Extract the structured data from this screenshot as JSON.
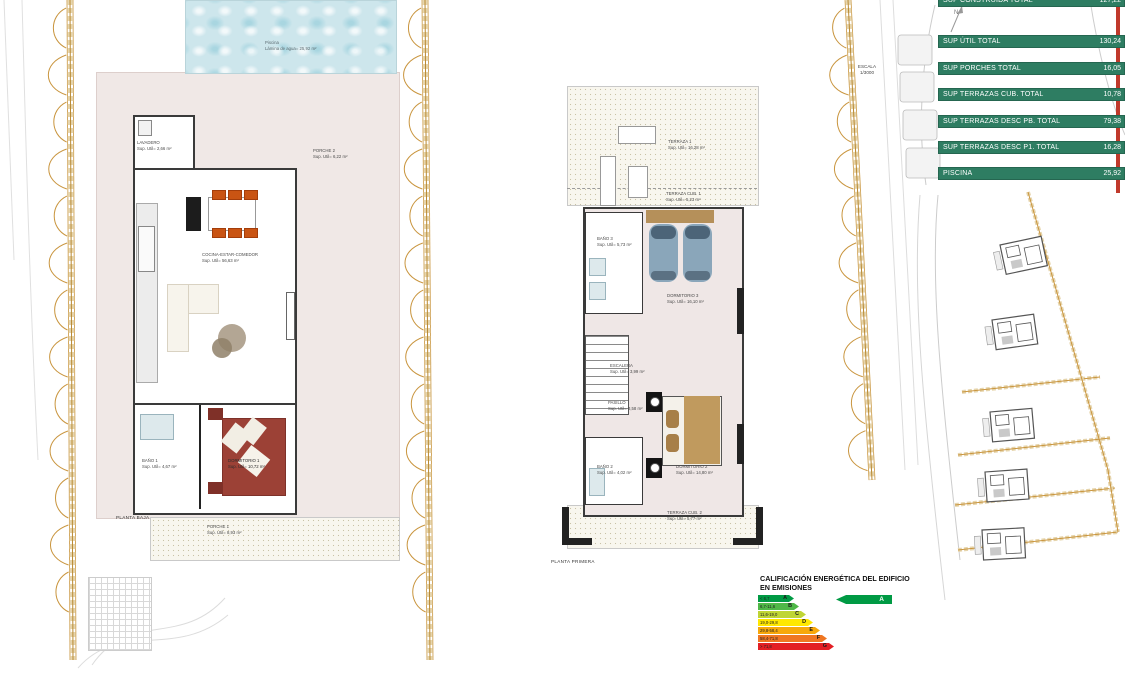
{
  "areas_table": {
    "bar_color": "#2e7d62",
    "rows": [
      {
        "label": "SUP CONSTRUIDA TOTAL",
        "value": "127,22"
      },
      {
        "label": "SUP ÚTIL TOTAL",
        "value": "130,24"
      },
      {
        "label": "SUP PORCHES TOTAL",
        "value": "16,05"
      },
      {
        "label": "SUP TERRAZAS CUB. TOTAL",
        "value": "10,78"
      },
      {
        "label": "SUP TERRAZAS DESC PB. TOTAL",
        "value": "79,38"
      },
      {
        "label": "SUP TERRAZAS DESC P1. TOTAL",
        "value": "16,28"
      },
      {
        "label": "PISCINA",
        "value": "25,92"
      }
    ]
  },
  "ground_floor": {
    "name_label": "PLANTA BAJA",
    "pool": {
      "line1": "Piscina",
      "line2": "Lámina de agua= 25,92 m²"
    },
    "rooms": [
      {
        "name": "LAVADERO",
        "area": "Sup. Util= 2,66 m²"
      },
      {
        "name": "PORCHE 2",
        "area": "Sup. Util= 6,22 m²"
      },
      {
        "name": "COCINA-ESTAR-COMEDOR",
        "area": "Sup. Util= 56,63 m²"
      },
      {
        "name": "BAÑO 1",
        "area": "Sup. Util= 4,67 m²"
      },
      {
        "name": "DORMITORIO 1",
        "area": "Sup. Util= 10,72 m²"
      },
      {
        "name": "PORCHE 1",
        "area": "Sup. Util= 8,93 m²"
      }
    ]
  },
  "first_floor": {
    "name_label": "PLANTA PRIMERA",
    "rooms": [
      {
        "name": "TERRAZA 1",
        "area": "Sup. Util= 16,28 m²"
      },
      {
        "name": "TERRAZA CUB. 1",
        "area": "Sup. Util= 5,23 m²"
      },
      {
        "name": "BAÑO 3",
        "area": "Sup. Util= 5,73 m²"
      },
      {
        "name": "DORMITORIO 3",
        "area": "Sup. Util= 16,10 m²"
      },
      {
        "name": "ESCALERA",
        "area": "Sup. Util= 3,99 m²"
      },
      {
        "name": "PASILLO",
        "area": "Sup. Util= 3,58 m²"
      },
      {
        "name": "BAÑO 2",
        "area": "Sup. Util= 4,02 m²"
      },
      {
        "name": "DORMITORIO 2",
        "area": "Sup. Util= 14,80 m²"
      },
      {
        "name": "TERRAZA CUB. 2",
        "area": "Sup. Util= 5,77 m²"
      }
    ]
  },
  "site_plan": {
    "scale_label": "ESCALA",
    "scale_value": "1/3000",
    "north_label": "N"
  },
  "energy": {
    "title_line1": "CALIFICACIÓN ENERGÉTICA DEL EDIFICIO",
    "title_line2": "EN EMISIONES",
    "rating": "A",
    "bands": [
      {
        "letter": "A",
        "range": "< 6,7",
        "color": "#009a44",
        "width": 36
      },
      {
        "letter": "B",
        "range": "6,7-11,6",
        "color": "#4fb848",
        "width": 41
      },
      {
        "letter": "C",
        "range": "11,6-19,0",
        "color": "#bfd535",
        "width": 48
      },
      {
        "letter": "D",
        "range": "19,0-29,8",
        "color": "#ffe800",
        "width": 55
      },
      {
        "letter": "E",
        "range": "29,8-58,4",
        "color": "#f7a80b",
        "width": 62
      },
      {
        "letter": "F",
        "range": "58,4-71,8",
        "color": "#ef7622",
        "width": 69
      },
      {
        "letter": "G",
        "range": "> 71,8",
        "color": "#e31e24",
        "width": 76
      }
    ]
  }
}
